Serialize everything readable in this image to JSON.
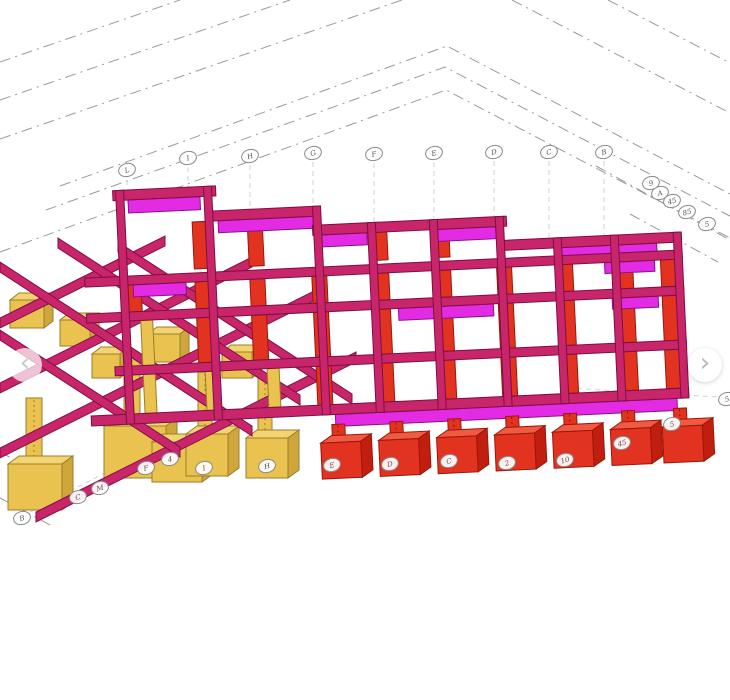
{
  "colors": {
    "beam_pink": "#C9256B",
    "beam_edge": "#7D0F42",
    "slab_magenta": "#E42BE4",
    "column_red": "#E23320",
    "footing_yellow": "#E9C24F",
    "gridline_gray": "#9A9A9A"
  },
  "nav": {
    "prev": {
      "icon": "chevron-left-icon",
      "glyph": "‹"
    },
    "next": {
      "icon": "chevron-right-icon",
      "glyph": "›"
    }
  },
  "grid_bubbles": {
    "top": [
      {
        "label": "L",
        "x": 127,
        "y": 170
      },
      {
        "label": "I",
        "x": 188,
        "y": 158
      },
      {
        "label": "H",
        "x": 250,
        "y": 156
      },
      {
        "label": "G",
        "x": 313,
        "y": 153
      },
      {
        "label": "F",
        "x": 374,
        "y": 154
      },
      {
        "label": "E",
        "x": 434,
        "y": 153
      },
      {
        "label": "D",
        "x": 494,
        "y": 152
      },
      {
        "label": "C",
        "x": 549,
        "y": 152
      },
      {
        "label": "B",
        "x": 604,
        "y": 152
      }
    ],
    "right_cluster": [
      {
        "label": "9",
        "x": 651,
        "y": 183
      },
      {
        "label": "A",
        "x": 660,
        "y": 193
      },
      {
        "label": "45",
        "x": 672,
        "y": 201
      },
      {
        "label": "85",
        "x": 687,
        "y": 212
      },
      {
        "label": "5",
        "x": 707,
        "y": 224
      }
    ],
    "bottom": [
      {
        "label": "B",
        "x": 22,
        "y": 518
      },
      {
        "label": "C",
        "x": 78,
        "y": 497
      },
      {
        "label": "M",
        "x": 100,
        "y": 488
      },
      {
        "label": "F",
        "x": 146,
        "y": 468
      },
      {
        "label": "4",
        "x": 170,
        "y": 459
      },
      {
        "label": "I",
        "x": 204,
        "y": 468
      },
      {
        "label": "H",
        "x": 267,
        "y": 466
      }
    ],
    "footings": [
      {
        "label": "E",
        "x": 332,
        "y": 465
      },
      {
        "label": "D",
        "x": 390,
        "y": 464
      },
      {
        "label": "C",
        "x": 449,
        "y": 461
      },
      {
        "label": "2",
        "x": 507,
        "y": 463
      },
      {
        "label": "10",
        "x": 565,
        "y": 460
      },
      {
        "label": "45",
        "x": 622,
        "y": 443
      },
      {
        "label": "5",
        "x": 672,
        "y": 424
      }
    ],
    "edge": [
      {
        "label": "5",
        "x": 727,
        "y": 399
      }
    ]
  }
}
